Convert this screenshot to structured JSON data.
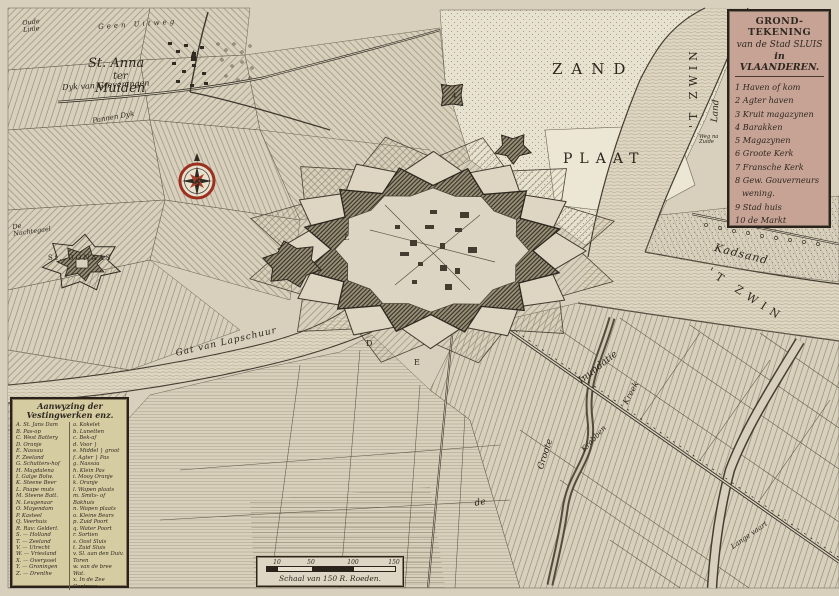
{
  "palette": {
    "paper": "#d8d0bd",
    "ink": "#2e2820",
    "water": "#ded6c2",
    "cartouche_bg": "#c7a395",
    "legend_bg": "#d6cca1",
    "compass_red": "#9c3020"
  },
  "icons": {
    "compass_rose": "eight-point-star-with-red-ring"
  },
  "cartouche": {
    "title_lines": [
      "GROND-TEKENING",
      "van de Stad SLUIS",
      "in VLAANDEREN."
    ],
    "items": [
      "1 Haven of kom",
      "2 Agter haven",
      "3 Kruit magazynen",
      "4 Barakken",
      "5 Magazynen",
      "6 Groote Kerk",
      "7 Fransche Kerk",
      "8 Gew. Gouverneurs wening.",
      "9 Stad huis",
      "10 de Markt"
    ]
  },
  "legend": {
    "header_line1": "Aanwyzing der",
    "header_line2": "Vestingwerken enz.",
    "left": [
      "A. St. Jans Dam",
      "B. Pas-op",
      "C. West Battery",
      "D. Oranje",
      "E. Nassau",
      "F. Zeeland",
      "G. Schutters-hof",
      "H. Magdalena",
      "I. Galge Bolw.",
      "K. Steene Beer",
      "L. Paape muts",
      "M. Steene Batt.",
      "N. Leugenaar",
      "O. Mayendam",
      "P. Kasteel",
      "Q. Veerhuis",
      "R. Rav: Gelderl.",
      "S. — Holland",
      "T. — Zeeland",
      "V. — Utrecht",
      "W. — Vriesland",
      "X. — Overyssel",
      "Y. — Groningen",
      "Z. — Drenthe"
    ],
    "right": [
      "a. Kokelet",
      "b. Lunetten",
      "c. Bek-af",
      "d. Voor }",
      "e. Middel } groot",
      "f. Agter } Pas",
      "g. Nassau",
      "h. Klein Pas",
      "i. Mooy Oranje",
      "k. Oranje",
      "l. Wapen plaats",
      "m. Smits- of Bakhuis",
      "n. Wapen plaats",
      "o. Kleine Beurs",
      "p. Zuid Poort",
      "q. Water Poort",
      "r. Sortien",
      "s. Oost Sluis",
      "t. Zuid Sluis",
      "v. Sl. aan den Duiv. Toren",
      "w. van de bree Wat.",
      "x. In de Zee Contresc."
    ]
  },
  "scale_bar": {
    "ticks": [
      "10",
      "50",
      "100",
      "150"
    ],
    "caption": "Schaal van 150 R. Roeden."
  },
  "map_labels": {
    "oude_linie": "Oude Linie",
    "geen_uitweg": "Geen Uitweg",
    "st_anna_line1": "St. Anna",
    "st_anna_line2": "ter",
    "st_anna_line3": "Muiden",
    "dyk_greveningen": "Dyk van Greveningen",
    "pannen_dyk": "Pannen Dyk",
    "nachtegael": "De Nachtegael",
    "st_donaas": "St. DONAAS",
    "zand": "ZAND",
    "plaat": "PLAAT",
    "t_zwin_vertical": "'T ZWIN",
    "land": "Land",
    "weg_na_zuide": "Weg na Zuide",
    "kadsand": "Kadsand",
    "t_zwin_diagonal": "'T ZWIN",
    "gat_van_lapschuur": "Gat van Lapschuur",
    "inundatie": "Inundatie",
    "kreek": "Kreek",
    "krabben": "Krabben",
    "groote": "Groote",
    "de": "de",
    "lange_vaart": "Lange vaart",
    "marker_d": "D",
    "marker_e": "E",
    "marker_l": "L",
    "marker_4": "4"
  }
}
